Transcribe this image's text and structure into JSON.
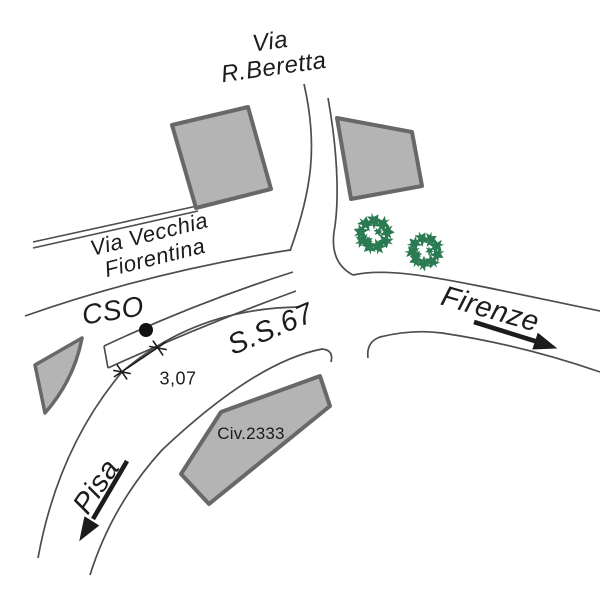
{
  "map": {
    "type": "street-location-sketch",
    "labels": {
      "via_r_beretta": {
        "line1": "Via",
        "line2": "R.Beretta"
      },
      "via_vecchia_fiorentina": {
        "line1": "Via Vecchia",
        "line2": "Fiorentina"
      },
      "cso": "CSO",
      "ss67": "S.S.67",
      "firenze": "Firenze",
      "pisa": "Pisa",
      "civico": "Civ.2333",
      "lane_width": "3,07"
    },
    "arrows": [
      {
        "label": "Firenze",
        "direction": "down-right"
      },
      {
        "label": "Pisa",
        "direction": "down-left"
      }
    ],
    "features": {
      "buildings_count": 4,
      "trees_count": 2,
      "measurement_dot": "black dot on CSO lane edge",
      "dimension_between": "CSO island edge and inner road edge"
    }
  },
  "colors": {
    "background": "#ffffff",
    "road_line": "#4d4d4d",
    "building_fill": "#b4b4b4",
    "building_stroke": "#686868",
    "tree_green": "#2a7a52",
    "ink": "#1c1c1c"
  }
}
